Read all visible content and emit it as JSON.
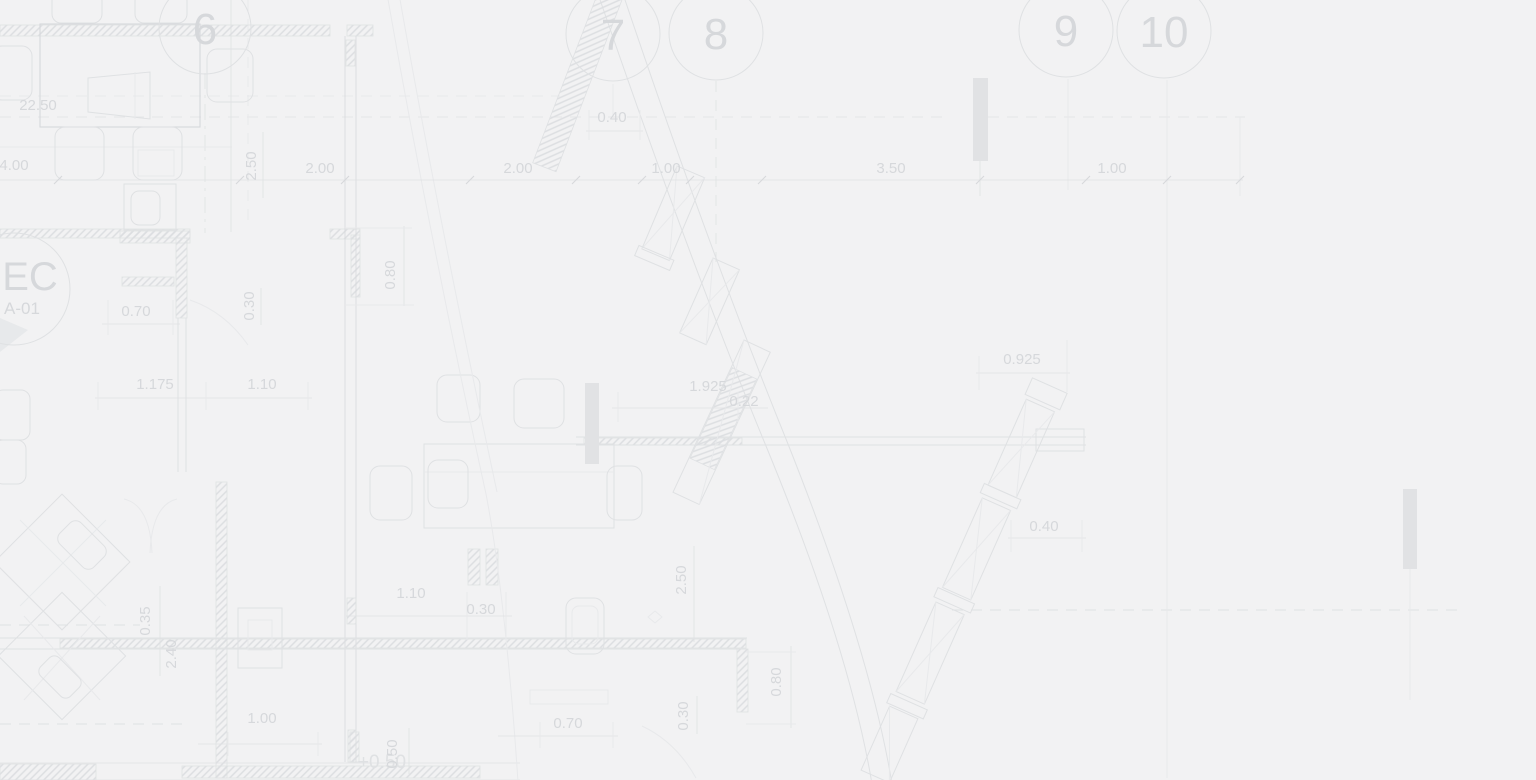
{
  "page": {
    "description": "Faint architectural floor plan blueprint background"
  },
  "colors": {
    "background": "#f2f2f3",
    "line": "#dfe1e3",
    "line_faint": "#e8e9eb",
    "line_strong": "#d6d8db",
    "text": "#d6d8db",
    "hatch": "#dcdee1",
    "bar_fill": "#e1e2e4"
  },
  "grid_bubbles": [
    {
      "label": "6"
    },
    {
      "label": "7"
    },
    {
      "label": "8"
    },
    {
      "label": "9"
    },
    {
      "label": "10"
    }
  ],
  "room_tag": {
    "name": "EC",
    "code": "A-01"
  },
  "level_marker": {
    "label": "+0.50"
  },
  "dims_h": [
    {
      "label": "22.50"
    },
    {
      "label": "4.00"
    },
    {
      "label": "2.00"
    },
    {
      "label": "2.00"
    },
    {
      "label": "0.40"
    },
    {
      "label": "1.00"
    },
    {
      "label": "3.50"
    },
    {
      "label": "1.00"
    },
    {
      "label": "0.70"
    },
    {
      "label": "1.175"
    },
    {
      "label": "1.10"
    },
    {
      "label": "1.925"
    },
    {
      "label": "0.22"
    },
    {
      "label": "0.925"
    },
    {
      "label": "0.40"
    },
    {
      "label": "1.10"
    },
    {
      "label": "0.30"
    },
    {
      "label": "0.70"
    },
    {
      "label": "1.00"
    }
  ],
  "dims_v": [
    {
      "label": "2.50"
    },
    {
      "label": "0.30"
    },
    {
      "label": "0.80"
    },
    {
      "label": "0.35"
    },
    {
      "label": "2.40"
    },
    {
      "label": "2.50"
    },
    {
      "label": "0.30"
    },
    {
      "label": "0.80"
    },
    {
      "label": "0.50"
    }
  ]
}
